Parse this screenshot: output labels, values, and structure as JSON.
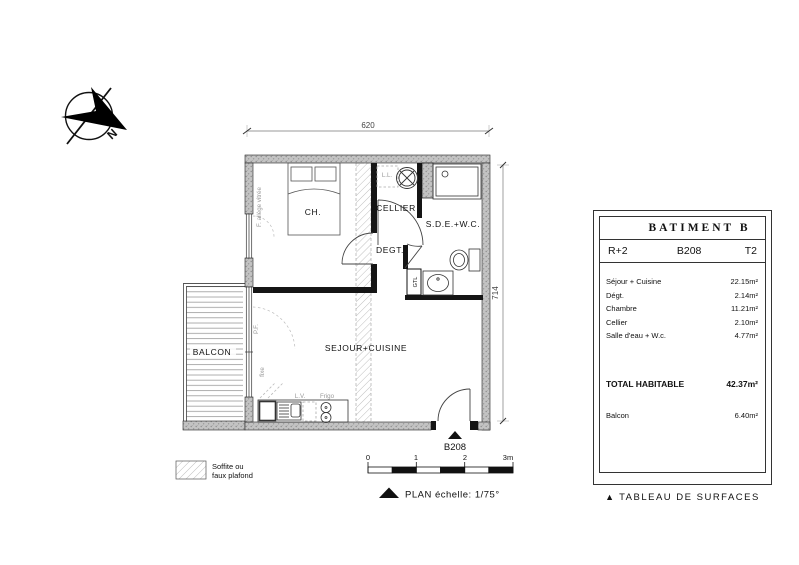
{
  "compass": {
    "north": "N"
  },
  "dimensions": {
    "width": "620",
    "height": "714"
  },
  "plan": {
    "rooms": {
      "chambre": "CH.",
      "cellier": "CELLIER",
      "degagement": "DEGT.",
      "sde_wc": "S.D.E.+W.C.",
      "sejour_cuisine": "SEJOUR+CUISINE",
      "balcon": "BALCON"
    },
    "annotations": {
      "lave_linge": "L.L.",
      "lave_vaisselle": "L.V.",
      "frigo": "Frigo",
      "gtl": "GTL",
      "fenetre": "F. allège vitrée",
      "porte_fenetre": "P.F.",
      "fixe": "fixe"
    },
    "entrance_label": "B208"
  },
  "legend": {
    "line1": "Soffite ou",
    "line2": "faux plafond"
  },
  "scale_bar": {
    "ticks": [
      "0",
      "1",
      "2",
      "3m"
    ],
    "caption": "PLAN échelle: 1/75°"
  },
  "surface_table": {
    "title": "BATIMENT B",
    "floor": "R+2",
    "unit": "B208",
    "type": "T2",
    "rows": [
      {
        "label": "Séjour + Cuisine",
        "value": "22.15m²"
      },
      {
        "label": "Dégt.",
        "value": "2.14m²"
      },
      {
        "label": "Chambre",
        "value": "11.21m²"
      },
      {
        "label": "Cellier",
        "value": "2.10m²"
      },
      {
        "label": "Salle d'eau + W.c.",
        "value": "4.77m²"
      }
    ],
    "total_label": "TOTAL HABITABLE",
    "total_value": "42.37m²",
    "balcony_label": "Balcon",
    "balcony_value": "6.40m²",
    "caption": "TABLEAU DE SURFACES"
  },
  "icons": {
    "marker": "▲"
  }
}
